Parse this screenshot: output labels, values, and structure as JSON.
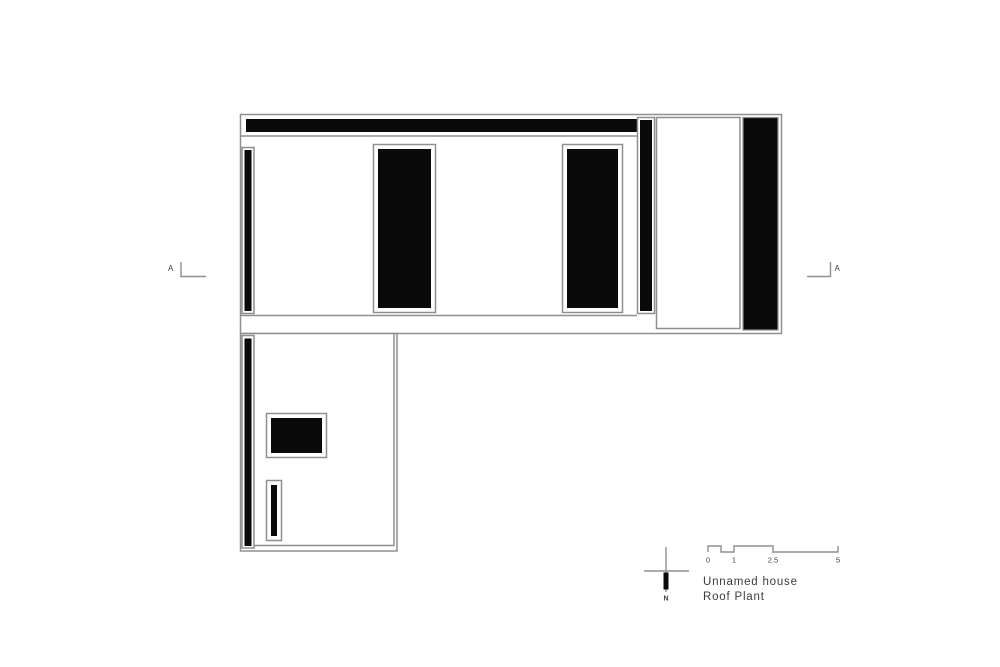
{
  "colors": {
    "background": "#ffffff",
    "ink": "#0a0a0a",
    "line": "#8f8f8f",
    "text": "#3c3c3c"
  },
  "section_markers": {
    "left_label": "A",
    "right_label": "A"
  },
  "north_indicator": {
    "label": "N"
  },
  "scale_bar": {
    "labels": [
      "0",
      "1",
      "2.5",
      "5"
    ]
  },
  "title_block": {
    "line1": "Unnamed house",
    "line2": "Roof Plant"
  }
}
